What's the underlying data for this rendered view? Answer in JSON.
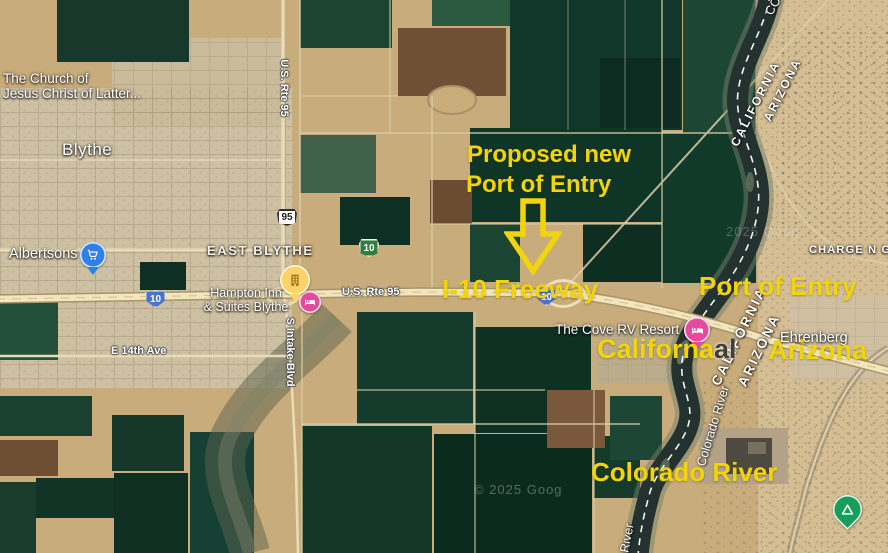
{
  "colors": {
    "annotation": "#f2d40a",
    "river": "#24322f",
    "freeway": "#f3e6bd",
    "pin_blue": "#2f80ed",
    "pin_pink": "#e64a9c",
    "pin_hotel": "#fcd36b",
    "pin_green": "#189d5b",
    "shield_blue": "#4a73c9",
    "shield_green": "#2f7d3f"
  },
  "annotations": {
    "proposed_line1": "Proposed new",
    "proposed_line2": "Port of Entry",
    "freeway_label": "I-10 Freeway",
    "port_of_entry": "Port of Entry",
    "california": "Californa",
    "california_overlap": "al",
    "arizona": "Arizona",
    "colorado_river": "Colorado River"
  },
  "labels": {
    "church_line1": "The Church of",
    "church_line2": "Jesus Christ of Latter...",
    "city": "Blythe",
    "district": "EAST BLYTHE",
    "albertsons": "Albertsons",
    "hampton_line1": "Hampton Inn",
    "hampton_line2": "& Suites Blythe",
    "us_rte_95": "U.S. Rte 95",
    "e_14th_ave": "E 14th Ave",
    "s_intake_blvd": "S Intake Blvd",
    "cove_rv": "The Cove RV Resort",
    "ehrenberg": "Ehrenberg",
    "charge": "CHARGE N G",
    "state_california": "CALIFORNIA",
    "state_arizona": "ARIZONA",
    "colorado_river_map": "Colorado River",
    "river_partial": "River",
    "co_partial": "CO",
    "watermark_1": "© 2025 Goog",
    "watermark_2": "2025 Goog"
  },
  "shields": {
    "us95": "95",
    "i10": "10",
    "biz10": "10"
  }
}
